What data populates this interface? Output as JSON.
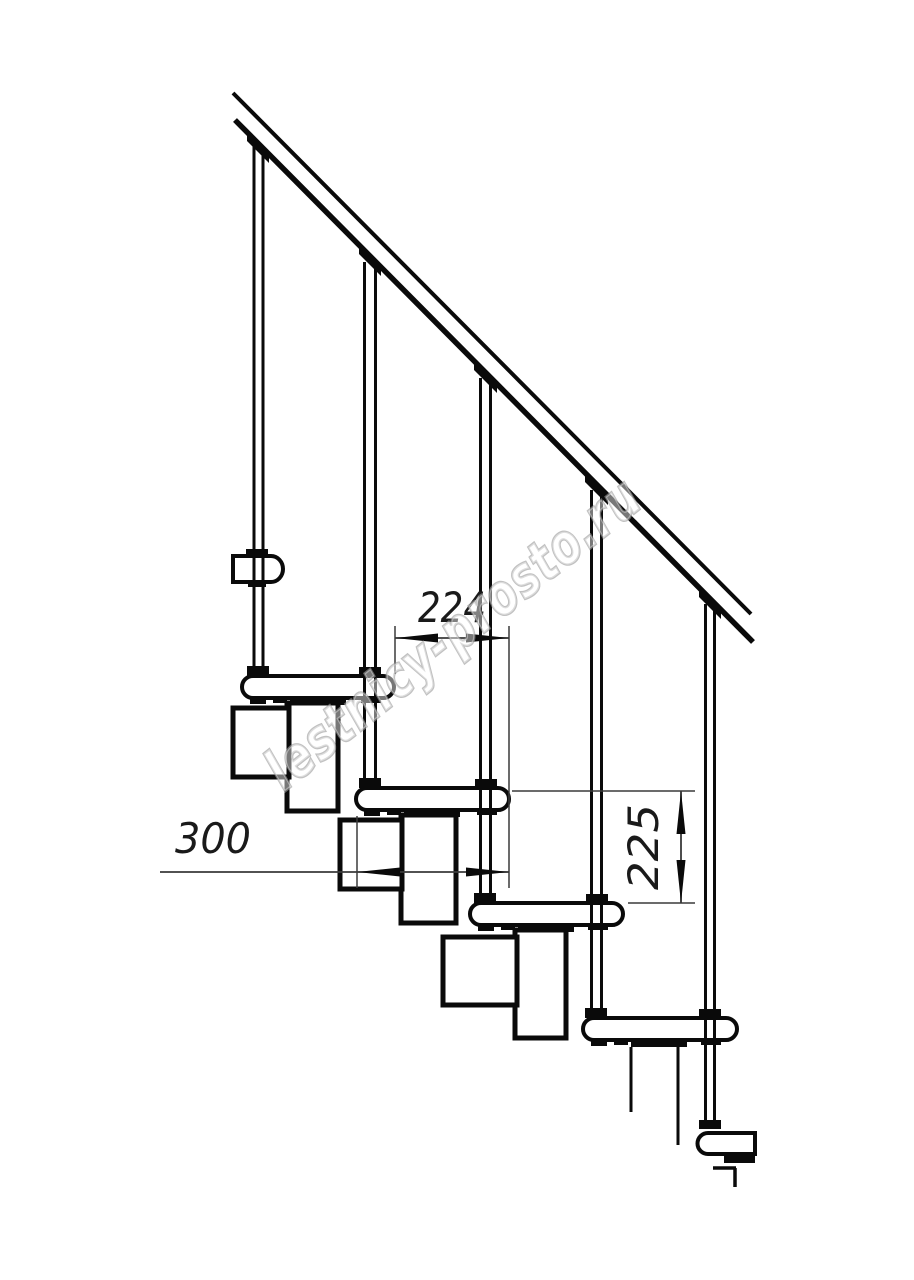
{
  "drawing": {
    "type": "staircase-side-view-technical-drawing",
    "watermark": "lestnicy-prosto.ru",
    "dimensions": {
      "step_spacing": "224",
      "tread_depth": "300",
      "riser_height": "225"
    },
    "colors": {
      "line": "#0a0a0a",
      "dimension_line": "#3a3a3a",
      "dimension_text": "#1a1a1a",
      "watermark_stroke": "#9b9b9b",
      "background": "#ffffff"
    }
  }
}
